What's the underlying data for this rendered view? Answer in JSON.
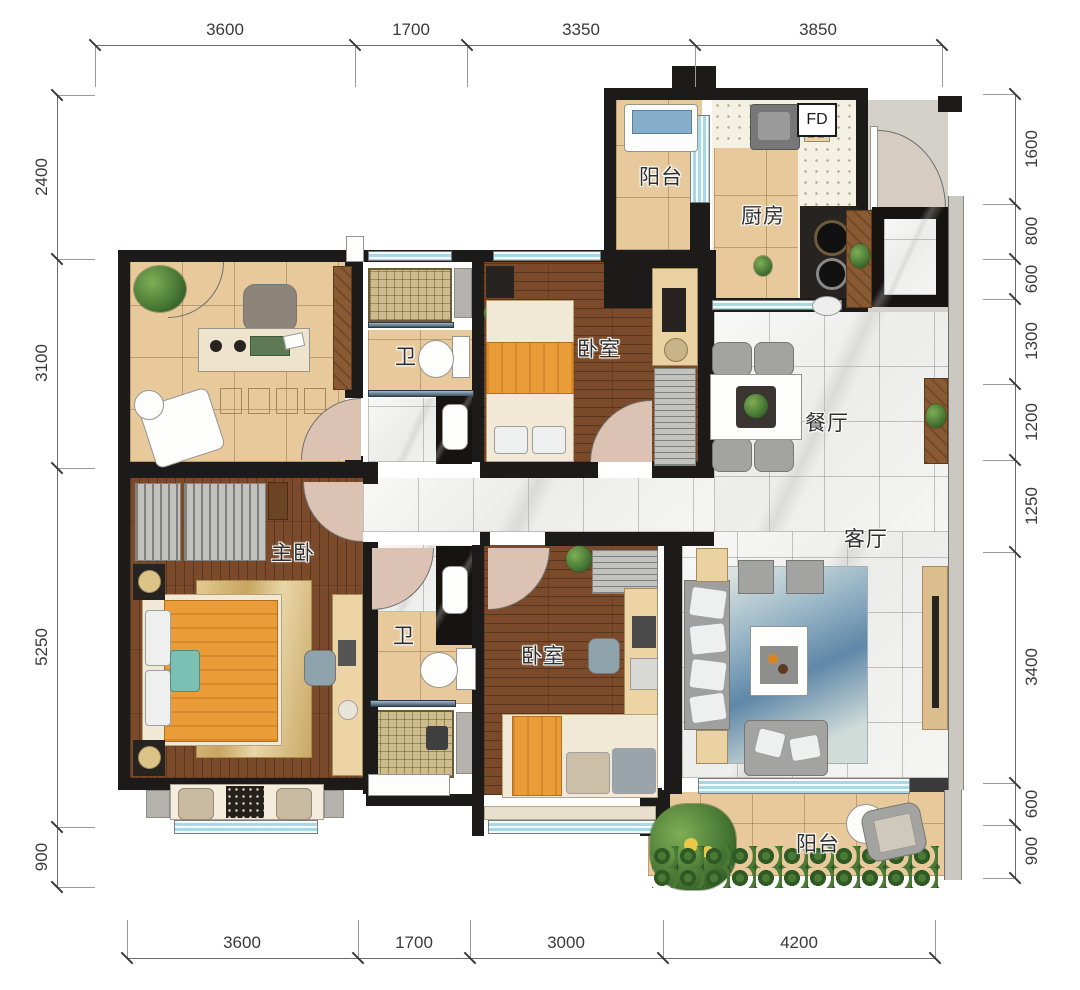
{
  "plan": {
    "rooms": [
      {
        "id": "balcony-top",
        "label": "阳台"
      },
      {
        "id": "kitchen",
        "label": "厨房"
      },
      {
        "id": "bath-top",
        "label": "卫"
      },
      {
        "id": "bedroom-top",
        "label": "卧室"
      },
      {
        "id": "dining",
        "label": "餐厅"
      },
      {
        "id": "master-bedroom",
        "label": "主卧"
      },
      {
        "id": "bath-bottom",
        "label": "卫"
      },
      {
        "id": "bedroom-bottom",
        "label": "卧室"
      },
      {
        "id": "living",
        "label": "客厅"
      },
      {
        "id": "balcony-bottom",
        "label": "阳台"
      }
    ],
    "markers": {
      "fd": "FD"
    }
  },
  "dimensions": {
    "top": [
      "3600",
      "1700",
      "3350",
      "3850"
    ],
    "bottom": [
      "3600",
      "1700",
      "3000",
      "4200"
    ],
    "left": [
      "2400",
      "3100",
      "5250",
      "900"
    ],
    "right": [
      "1600",
      "800",
      "600",
      "1300",
      "1200",
      "1250",
      "3400",
      "600",
      "900"
    ]
  },
  "colors": {
    "wall": "#1d1b19",
    "wood_light": "#e7c99c",
    "wood_dark": "#7a4a2a",
    "marble": "#f4f4f2",
    "window": "#a9d8e4",
    "bed_orange": "#e99c38",
    "plant_green": "#4a7a36"
  }
}
